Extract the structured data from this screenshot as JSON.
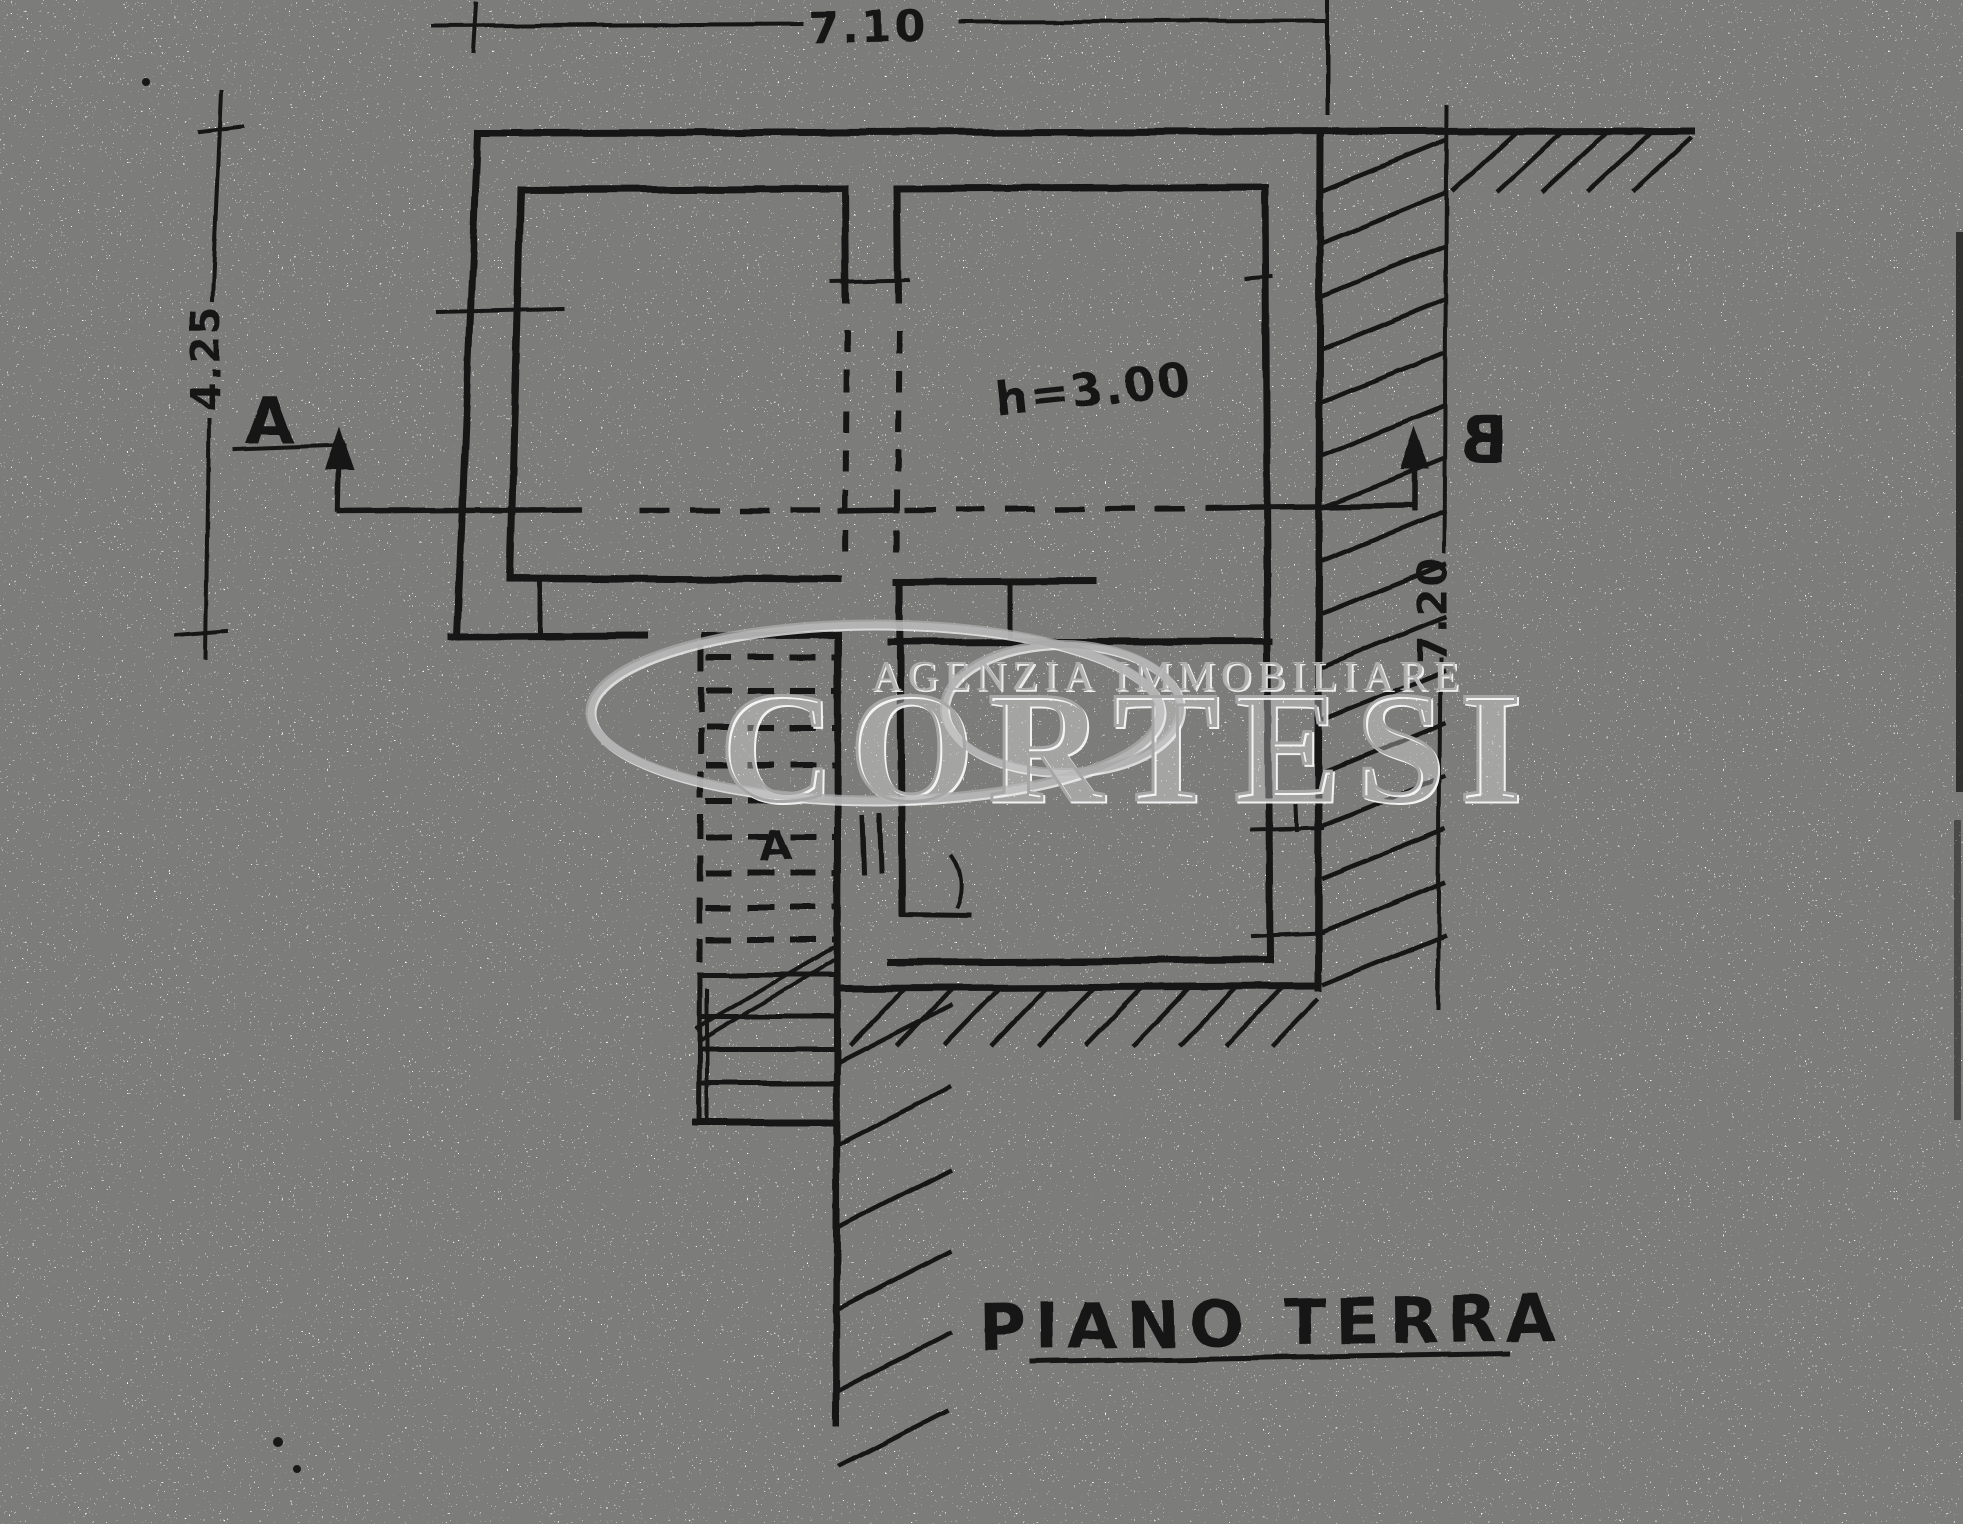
{
  "title": {
    "text": "PIANO TERRA"
  },
  "dimensions": {
    "top_width_m": "7.10",
    "left_height_m": "4.25",
    "right_height_m": "7.20"
  },
  "annotations": {
    "room_height": "h=3.00"
  },
  "section_markers": {
    "a": "A",
    "b": "B"
  },
  "stair": {
    "label": "A"
  },
  "watermark": {
    "agency_line": "AGENZIA IMMOBILIARE",
    "brand": "CORTESI",
    "color": "#a9a9a9"
  },
  "colors": {
    "ink": "#161616",
    "paper": "#fbfaf7"
  }
}
